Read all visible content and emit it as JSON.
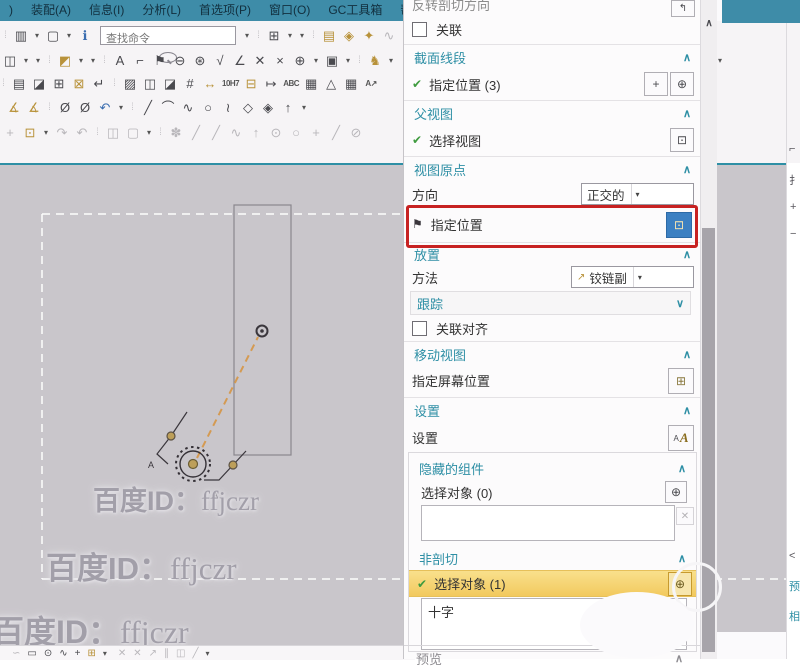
{
  "colors": {
    "accent_teal": "#2e8fa5",
    "menu_bg": "#3e8ca8",
    "canvas_bg": "#c9c6cb",
    "highlight_yellow": "#f6d26e",
    "red_box": "#c72222",
    "selected_blue": "#3c80c2",
    "gold": "#b8923a"
  },
  "menu": {
    "items": [
      ")",
      "装配(A)",
      "信息(I)",
      "分析(L)",
      "首选项(P)",
      "窗口(O)",
      "GC工具箱",
      "帮助(H)"
    ]
  },
  "toolbars": {
    "search_placeholder": "查找命令",
    "row1a": [
      {
        "g": "⁞",
        "c": "sep"
      },
      {
        "g": "▥",
        "n": "pattern-icon"
      },
      {
        "g": "▾",
        "c": "dd",
        "n": "dropdown-arrow-icon"
      },
      {
        "g": "▢",
        "n": "color-swatch-icon"
      },
      {
        "g": "▾",
        "c": "dd",
        "n": "dropdown-arrow-icon"
      },
      {
        "g": "ℹ",
        "c": "blue",
        "n": "info-tag-icon"
      }
    ],
    "row1b": [
      {
        "g": "▾",
        "c": "dd",
        "n": "dropdown-arrow-icon"
      },
      {
        "g": "⁞",
        "c": "sep"
      },
      {
        "g": "⊞",
        "n": "window-layout-icon"
      },
      {
        "g": "▾",
        "c": "dd"
      },
      {
        "g": "▾",
        "c": "dd"
      },
      {
        "g": "⁞",
        "c": "sep"
      },
      {
        "g": "▤",
        "c": "gold",
        "n": "layers-icon"
      },
      {
        "g": "◈",
        "c": "gold",
        "n": "tag-icon"
      },
      {
        "g": "✦",
        "c": "gold",
        "n": "key-icon"
      },
      {
        "g": "∿",
        "c": "dis",
        "n": "cut-icon"
      }
    ],
    "row2": [
      {
        "g": "◫",
        "n": "split-window-icon"
      },
      {
        "g": "▾",
        "c": "dd"
      },
      {
        "g": "▾",
        "c": "dd"
      },
      {
        "g": "⁞",
        "c": "sep"
      },
      {
        "g": "◩",
        "c": "gold",
        "n": "component-icon"
      },
      {
        "g": "▾",
        "c": "dd"
      },
      {
        "g": "▾",
        "c": "dd"
      },
      {
        "g": "⁞",
        "c": "sep"
      },
      {
        "g": "A",
        "n": "text-icon"
      },
      {
        "g": "⌐",
        "n": "fastener-icon"
      },
      {
        "g": "⚑",
        "n": "flag-note-icon"
      },
      {
        "g": "⊖",
        "n": "zoom-out-icon"
      },
      {
        "g": "⊛",
        "n": "zoom-help-icon"
      },
      {
        "g": "√",
        "n": "check-icon"
      },
      {
        "g": "∠",
        "n": "angle-icon"
      },
      {
        "g": "✕",
        "n": "delete-icon"
      },
      {
        "g": "×",
        "n": "trim-icon"
      },
      {
        "g": "⊕",
        "n": "point-icon"
      },
      {
        "g": "▾",
        "c": "dd"
      },
      {
        "g": "▣",
        "n": "image-icon"
      },
      {
        "g": "▾",
        "c": "dd"
      },
      {
        "g": "⁞",
        "c": "sep"
      },
      {
        "g": "♞",
        "c": "gold",
        "n": "animal-icon"
      },
      {
        "g": "▾",
        "c": "dd"
      }
    ],
    "row3": [
      {
        "g": "⁞",
        "c": "sep"
      },
      {
        "g": "▤",
        "n": "booklet-icon"
      },
      {
        "g": "◪",
        "n": "shaded-view-icon"
      },
      {
        "g": "⊞",
        "n": "balloon-grid-icon"
      },
      {
        "g": "⊠",
        "c": "gold",
        "n": "stamp-icon"
      },
      {
        "g": "↵",
        "n": "corner-arrow-icon"
      },
      {
        "g": "⁞",
        "c": "sep"
      },
      {
        "g": "▨",
        "n": "hatch-section-icon"
      },
      {
        "g": "◫",
        "n": "base-view-icon"
      },
      {
        "g": "◪",
        "n": "partial-view-icon"
      },
      {
        "g": "#",
        "n": "dimension-grid-icon"
      },
      {
        "g": "↔",
        "c": "gold",
        "n": "linear-dim-icon"
      },
      {
        "g": "10H7",
        "c": "txt",
        "n": "fit-tolerance-icon"
      },
      {
        "g": "⊟",
        "c": "gold",
        "n": "datum-icon"
      },
      {
        "g": "↦",
        "n": "ordinate-dim-icon"
      },
      {
        "g": "ABC",
        "c": "txt",
        "n": "note-text-icon"
      },
      {
        "g": "▦",
        "n": "grid-icon"
      },
      {
        "g": "△",
        "n": "datum-triangle-icon"
      },
      {
        "g": "▦",
        "n": "table-icon"
      },
      {
        "g": "A↗",
        "c": "txt",
        "n": "leader-text-icon"
      }
    ],
    "row4": [
      {
        "g": "∡",
        "c": "gold",
        "n": "slope-dim-icon"
      },
      {
        "g": "∡",
        "c": "gold",
        "n": "taper-dim-icon"
      },
      {
        "g": "⁞",
        "c": "sep"
      },
      {
        "g": "Ø",
        "n": "diameter-icon"
      },
      {
        "g": "Ø",
        "n": "diameter-symbol-icon"
      },
      {
        "g": "↶",
        "c": "blue",
        "n": "undo-icon"
      },
      {
        "g": "▾",
        "c": "dd"
      },
      {
        "g": "⁞",
        "c": "sep"
      },
      {
        "g": "╱",
        "n": "line-icon"
      },
      {
        "g": "⌒",
        "n": "arc-icon"
      },
      {
        "g": "∿",
        "n": "polyline-icon"
      },
      {
        "g": "○",
        "n": "circle-icon"
      },
      {
        "g": "≀",
        "n": "spline-icon"
      },
      {
        "g": "◇",
        "n": "polygon-icon"
      },
      {
        "g": "◈",
        "n": "plane-icon"
      },
      {
        "g": "↑",
        "n": "normal-icon"
      },
      {
        "g": "▾",
        "c": "dd"
      }
    ],
    "row5": [
      {
        "g": "+",
        "c": "dis",
        "n": "move-icon"
      },
      {
        "g": "⊡",
        "c": "gold",
        "n": "sketch-box-icon"
      },
      {
        "g": "▾",
        "c": "dd"
      },
      {
        "g": "↷",
        "c": "dis",
        "n": "redo-rotate-icon"
      },
      {
        "g": "↶",
        "c": "dis",
        "n": "undo-rotate-icon"
      },
      {
        "g": "⁞",
        "c": "sep"
      },
      {
        "g": "◫",
        "c": "dis",
        "n": "copy-view-icon"
      },
      {
        "g": "▢",
        "c": "dis",
        "n": "selection-rect-icon"
      },
      {
        "g": "▾",
        "c": "dd"
      },
      {
        "g": "⁞",
        "c": "sep"
      },
      {
        "g": "✽",
        "c": "dis",
        "n": "snap-point-icon"
      },
      {
        "g": "╱",
        "c": "dis",
        "n": "snap-endpoint-icon"
      },
      {
        "g": "╱",
        "c": "dis",
        "n": "snap-midpoint-icon"
      },
      {
        "g": "∿",
        "c": "dis",
        "n": "snap-curve-icon"
      },
      {
        "g": "↑",
        "c": "dis",
        "n": "snap-pole-icon"
      },
      {
        "g": "⊙",
        "c": "dis",
        "n": "snap-center-icon"
      },
      {
        "g": "○",
        "c": "dis",
        "n": "snap-circle-icon"
      },
      {
        "g": "+",
        "c": "dis",
        "n": "snap-intersection-icon"
      },
      {
        "g": "╱",
        "c": "dis",
        "n": "snap-tangent-icon"
      },
      {
        "g": "⊘",
        "c": "dis",
        "n": "snap-quadrant-icon"
      }
    ],
    "bottom": [
      {
        "g": "∽",
        "c": "dis",
        "n": "curve-icon"
      },
      {
        "g": "▭",
        "n": "rectangle-icon"
      },
      {
        "g": "⊙",
        "n": "circle-dot-icon"
      },
      {
        "g": "∿",
        "n": "studio-spline-icon"
      },
      {
        "g": "+",
        "n": "point-plus-icon"
      },
      {
        "g": "⊞",
        "c": "gold",
        "n": "sketch-icon"
      },
      {
        "g": "▾",
        "c": "dd"
      },
      {
        "g": "✕",
        "c": "dis",
        "n": "intersect-icon"
      },
      {
        "g": "✕",
        "c": "dis",
        "n": "intersect2-icon"
      },
      {
        "g": "↗",
        "c": "dis",
        "n": "project-icon"
      },
      {
        "g": "∥",
        "c": "dis",
        "n": "parallel-icon"
      },
      {
        "g": "◫",
        "c": "dis",
        "n": "mirror-icon"
      },
      {
        "g": "╱",
        "c": "dis",
        "n": "offset-icon"
      },
      {
        "g": "▾",
        "c": "dd dis"
      }
    ]
  },
  "canvas": {
    "watermark": {
      "prefix": "百度ID：",
      "id": "ffjczr"
    },
    "view_labels": [
      "A",
      "A"
    ]
  },
  "panel": {
    "top_row": {
      "label": "反转剖切方向",
      "icon": "↰"
    },
    "assoc": {
      "label": "关联"
    },
    "segments": {
      "title": "截面线段",
      "chev": "∧",
      "row": {
        "check": "✔",
        "label": "指定位置 (3)",
        "btn1": "+",
        "btn2": "⊕"
      }
    },
    "parent_view": {
      "title": "父视图",
      "chev": "∧",
      "row": {
        "check": "✔",
        "label": "选择视图",
        "btn": "⊡"
      }
    },
    "view_origin": {
      "title": "视图原点",
      "chev": "∧",
      "direction": {
        "label": "方向",
        "value": "正交的",
        "caret": "▾"
      },
      "specify": {
        "flag": "⚑",
        "label": "指定位置",
        "btn": "⊡"
      }
    },
    "placement": {
      "title": "放置",
      "chev": "∧",
      "method": {
        "label": "方法",
        "icon": "↗",
        "value": "铰链副",
        "caret": "▾"
      },
      "track": {
        "label": "跟踪",
        "chev": "∨"
      },
      "align": {
        "label": "关联对齐"
      }
    },
    "move_view": {
      "title": "移动视图",
      "chev": "∧",
      "row": {
        "label": "指定屏幕位置",
        "btn": "⊞"
      }
    },
    "settings": {
      "title": "设置",
      "chev": "∧",
      "row": {
        "label": "设置",
        "icon_a": "A",
        "icon_b": "A"
      }
    },
    "hidden": {
      "title": "隐藏的组件",
      "chev": "∧",
      "row": {
        "label": "选择对象 (0)",
        "btn": "⊕"
      },
      "close": "✕"
    },
    "nonsect": {
      "title": "非剖切",
      "chev": "∧",
      "row": {
        "check": "✔",
        "label": "选择对象 (1)",
        "btn": "⊕"
      },
      "list_item": "十字",
      "chev2": "∧"
    },
    "preview": {
      "label": "预览",
      "chev": "∧"
    }
  },
  "scrollbar": {
    "up": "∧"
  },
  "right_edge": {
    "glyphs": [
      "⌐",
      "扌",
      "+",
      "−",
      "<",
      "预",
      "相"
    ],
    "corner_caret": "▾",
    "dots": "⋯"
  }
}
